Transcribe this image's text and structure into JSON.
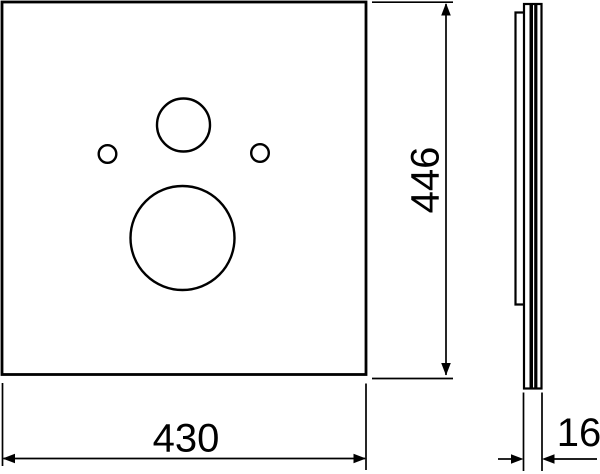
{
  "drawing": {
    "background_color": "#ffffff",
    "line_color": "#000000",
    "dimensions": {
      "width": "430",
      "height": "446",
      "thickness": "16"
    }
  }
}
